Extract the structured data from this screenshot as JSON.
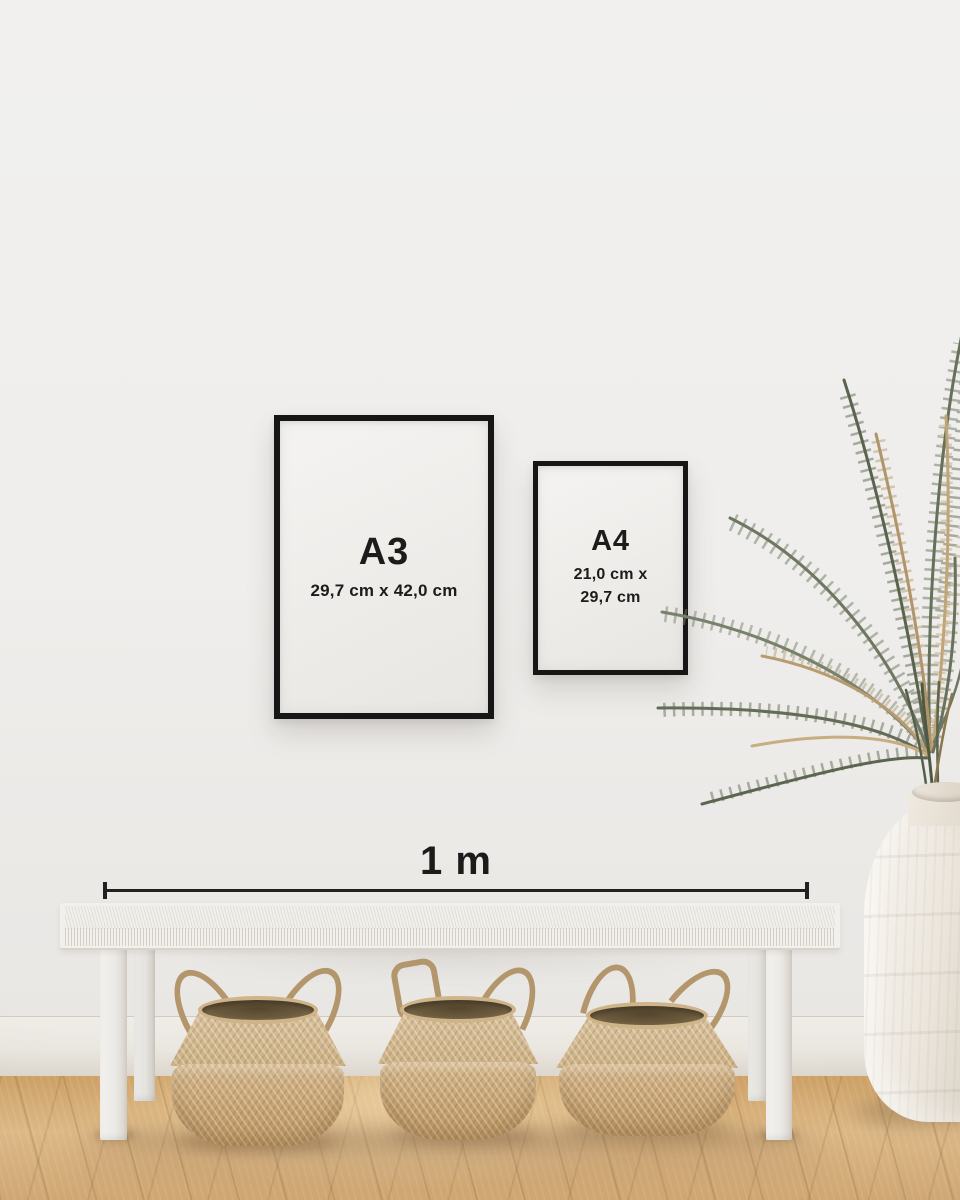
{
  "frames": [
    {
      "label": "A3",
      "dimensions": "29,7 cm x 42,0 cm"
    },
    {
      "label": "A4",
      "dimensions_line1": "21,0 cm x",
      "dimensions_line2": "29,7 cm"
    }
  ],
  "scale_bar": {
    "label": "1 m"
  },
  "colors": {
    "wall": "#efeeec",
    "frame": "#161616",
    "text": "#1c1c1c",
    "floor_wood": "#d3a873",
    "baseboard": "#eae6e0",
    "bench": "#f2f0ed",
    "basket": "#c9ad83",
    "basket_opening": "#6b5a3d",
    "vase": "#ece6dd",
    "leaf_green": "#68725c",
    "leaf_dried": "#b89c70"
  }
}
